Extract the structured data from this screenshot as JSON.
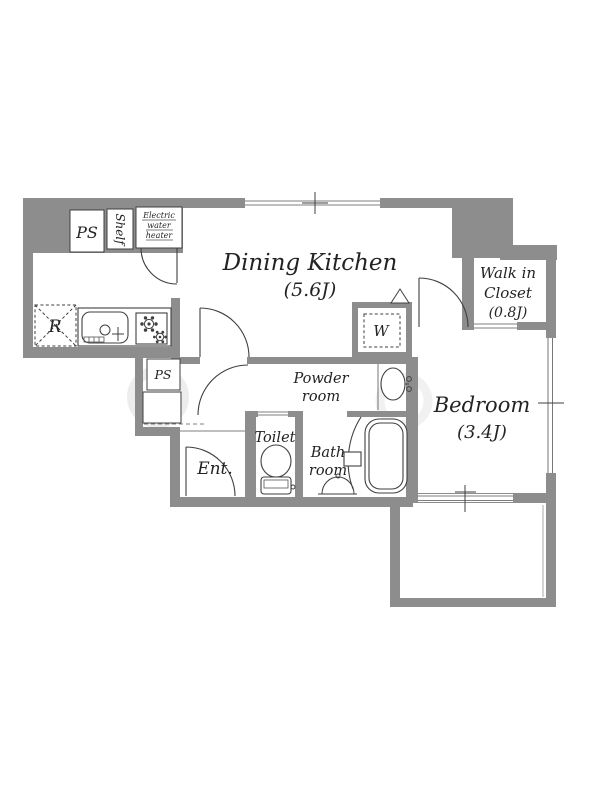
{
  "floorplan": {
    "rooms": {
      "dining_kitchen": {
        "name": "Dining Kitchen",
        "area": "(5.6J)"
      },
      "bedroom": {
        "name": "Bedroom",
        "area": "(3.4J)"
      },
      "walk_in_closet": {
        "name_line1": "Walk in",
        "name_line2": "Closet",
        "area": "(0.8J)"
      },
      "powder_room": {
        "name_line1": "Powder",
        "name_line2": "room"
      },
      "bath_room": {
        "name_line1": "Bath",
        "name_line2": "room"
      },
      "toilet": {
        "name": "Toilet"
      },
      "entrance": {
        "name": "Ent."
      }
    },
    "fixtures": {
      "pipe_space_upper": "PS",
      "pipe_space_lower": "PS",
      "shelf": "Shelf",
      "water_heater_line1": "Electric",
      "water_heater_line2": "water",
      "water_heater_line3": "heater",
      "refrigerator": "R",
      "washing_machine": "W"
    },
    "colors": {
      "wall": "#8d8d8d",
      "line": "#3f3f3f",
      "text": "#232323",
      "background": "#ffffff"
    }
  }
}
